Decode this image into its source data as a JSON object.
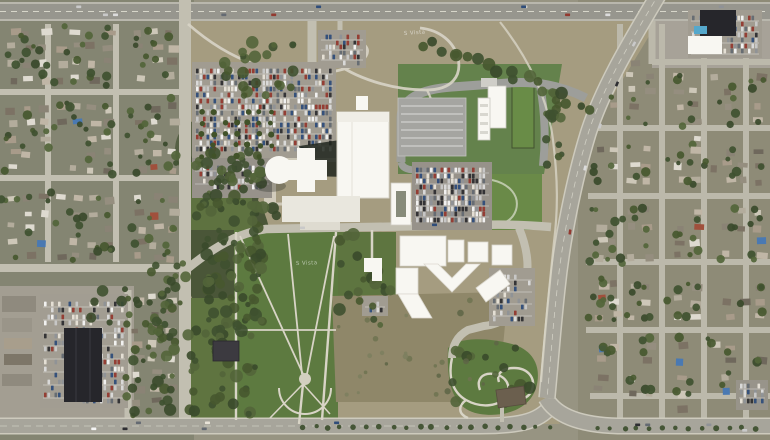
{
  "map": {
    "labels": [
      {
        "text": "S Vista",
        "x": 404,
        "y": 35,
        "rotate": -4
      },
      {
        "text": "S Vista",
        "x": 296,
        "y": 265,
        "rotate": -2
      }
    ],
    "palette": {
      "base": "#979482",
      "campusField": "#a59c80",
      "residentialL": "#848572",
      "residentialR": "#8e8b77",
      "roadLocal": "#c2bfb1",
      "roadMajor": "#a7a59b",
      "highway": "#97968e",
      "sidewalk": "#d8d4c6",
      "laneLine": "#e8e6da",
      "woods": "#4a5638",
      "tree": "#3f5130",
      "lawn": "#5d7a40",
      "lawnBright": "#698c47",
      "renderLawn": "#64824c",
      "renderRoad": "#9d9e9a",
      "parking": "#a19c91",
      "parkingDark": "#97928a",
      "building": "#f8f7f2",
      "plaza": "#e9e7de",
      "roofDark": "#26262b",
      "pool": "#55a8cc",
      "scrub": "#8f8769",
      "label": "#ffffff"
    },
    "houseRoofs": [
      "#cdc7b8",
      "#b3ac9c",
      "#958e7f",
      "#a89b8a",
      "#8a8375",
      "#6f685c",
      "#c0b6a6",
      "#7c7264",
      "#dedad0"
    ],
    "accentRoofs": [
      "#4a79b2",
      "#a0503c"
    ],
    "treeGreens": [
      "#3f5130",
      "#47582f",
      "#53653a",
      "#3a4a2b"
    ],
    "carColors": [
      "#f5f5f5",
      "#dcdcdc",
      "#2e2e32",
      "#8f9297",
      "#646a72",
      "#93392f",
      "#2f4d7a",
      "#c9c9c9",
      "#e8e3d8"
    ]
  }
}
